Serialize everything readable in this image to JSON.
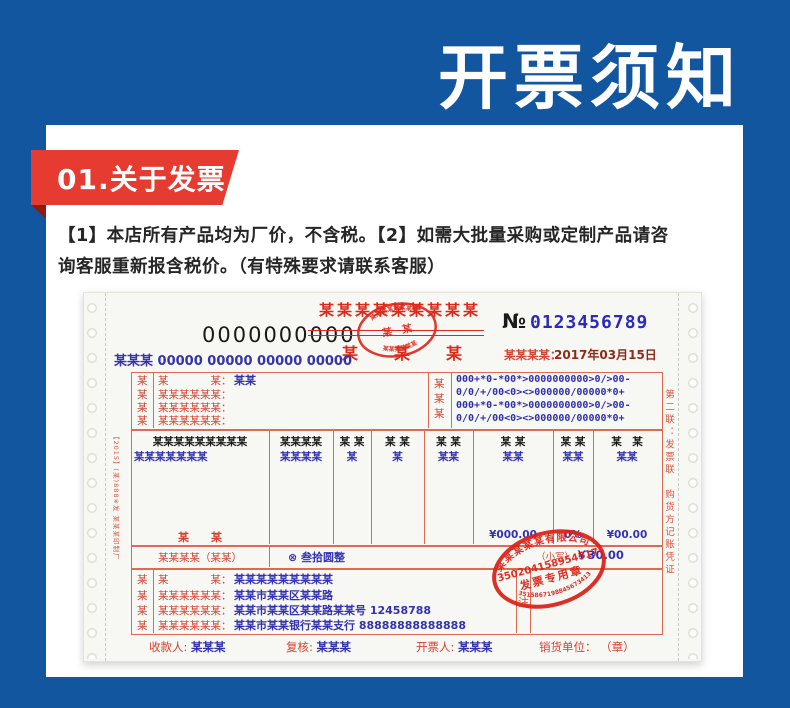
{
  "page": {
    "hero_title": "开票须知",
    "colors": {
      "background_blue": "#1356a0",
      "badge_red": "#e63b30",
      "badge_fold_red": "#931911",
      "invoice_border_red": "#e06a50",
      "invoice_text_red": "#d6432e",
      "invoice_bright_red": "#e02818",
      "invoice_blue": "#3232b2",
      "panel_white": "#ffffff"
    }
  },
  "section": {
    "badge_label": "01.关于发票",
    "paragraph_line1": "【1】本店所有产品均为厂价，不含税。【2】如需大批量采购或定制产品请咨",
    "paragraph_line2": "询客服重新报含税价。（有特殊要求请联系客服）"
  },
  "invoice": {
    "serial_black": "0000000000",
    "title_top": "某某某某某某某某某",
    "title_bottom": "某　某　某",
    "no_label": "№",
    "no_value": "0123456789",
    "date_label": "某某某某：",
    "date_value": "2017年03月15日",
    "code_line": "某某某 00000 00000 00000 00000",
    "top_stamp": {
      "arc_top": "某某某某某某某某",
      "center": "某　某",
      "arc_bottom": "某某某某某某"
    },
    "buyer": {
      "col_chars": [
        "某",
        "某",
        "某",
        "某"
      ],
      "row1_label": "某　　　　某：",
      "row1_value": "某某",
      "row2_label": "某某某某某某：",
      "row3_label": "某某某某某某：",
      "row4_label": "某某某某某某：",
      "mid_chars": [
        "某",
        "某",
        "某"
      ],
      "code_lines": [
        "000+*0-*00*>0000000000>0/>00-",
        "0/0/+/00<0><>000000/00000*0+",
        "000+*0-*00*>0000000000>0/>00-",
        "0/0/+/00<0><>000000/00000*0+"
      ]
    },
    "table": {
      "headers": [
        "某某某某某某某某某",
        "某某某某",
        "某 某",
        "某 某",
        "某 某",
        "某 某",
        "某 某",
        "某　某"
      ],
      "values": [
        "某某某某某某某",
        "某某某某",
        "某",
        "某",
        "某某",
        "某某",
        "某某",
        "某某"
      ],
      "footer_label": "某　　某",
      "amount1": "¥000.00",
      "rate": "0%",
      "amount2": "¥00.00"
    },
    "totals": {
      "label": "某某某某（某某）",
      "capital": "⊗ 叁拾圆整",
      "small_label": "（小写）",
      "small_value": "￥30.00"
    },
    "seller": {
      "col_chars": [
        "某",
        "某",
        "某",
        "某"
      ],
      "row1_label": "某　　　　某：",
      "row1_value": "某某某某某某某某某",
      "row2_label": "某某某某某某：",
      "row2_value": "某某市某某区某某路",
      "row3_label": "某某某某某某：",
      "row3_value": "某某市某某区某某路某某号  12458788",
      "row4_label": "某某某某某某：",
      "row4_value": "某某市某某银行某某支行  88888888888888",
      "remark_label": "注"
    },
    "footer": {
      "payee_label": "收款人:",
      "payee_value": "某某某",
      "reviewer_label": "复核:",
      "reviewer_value": "某某某",
      "drawer_label": "开票人:",
      "drawer_value": "某某某",
      "seller_unit_label": "销货单位：",
      "seller_unit_value": "（章）"
    },
    "margin_left_text": "【2015】(某)888※发 某某某印制厂",
    "margin_right_text": "第二联：发票联　购货方记账凭证",
    "seal": {
      "company_arc": "某某某某某有限公司",
      "number": "350204158954517",
      "title": "发票专用章",
      "bottom_arc": "3515867198845673413"
    }
  }
}
